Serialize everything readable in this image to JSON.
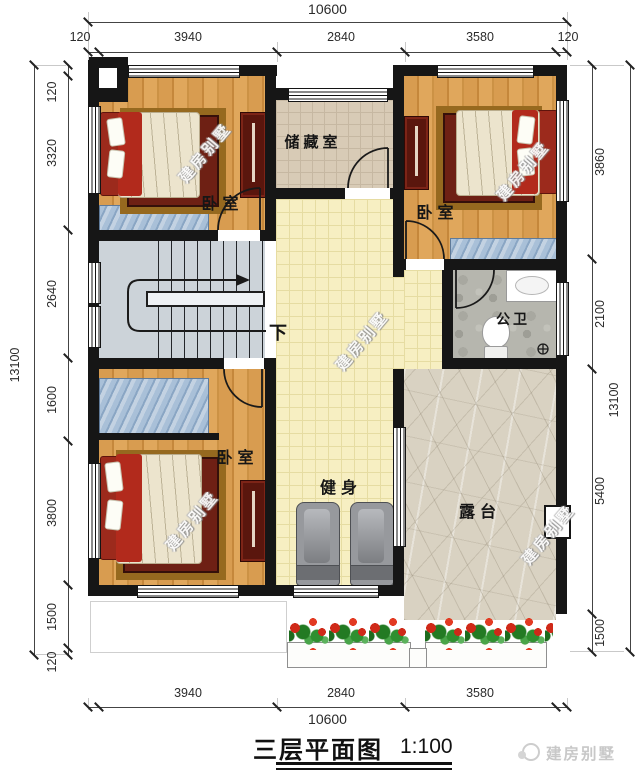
{
  "title": {
    "text": "三层平面图",
    "scale": "1:100"
  },
  "brand": {
    "name": "建房别墅"
  },
  "watermark": {
    "text": "建房别墅"
  },
  "rooms": {
    "bedroom_top_left": "卧室",
    "bedroom_top_right": "卧室",
    "bedroom_bottom_left": "卧室",
    "storage": "储藏室",
    "bathroom": "公卫",
    "gym": "健身",
    "terrace": "露台",
    "stairs_down": "下"
  },
  "dimensions": {
    "top": {
      "overall": "10600",
      "segments": [
        "120",
        "3940",
        "2840",
        "3580",
        "120"
      ]
    },
    "bottom": {
      "overall": "10600",
      "segments": [
        "3940",
        "2840",
        "3580"
      ]
    },
    "left": {
      "overall": "13100",
      "segments": [
        "120",
        "3320",
        "2640",
        "1600",
        "3800",
        "1500",
        "120"
      ]
    },
    "right": {
      "overall": "13100",
      "segments": [
        "3860",
        "2100",
        "5400",
        "1500"
      ]
    }
  }
}
